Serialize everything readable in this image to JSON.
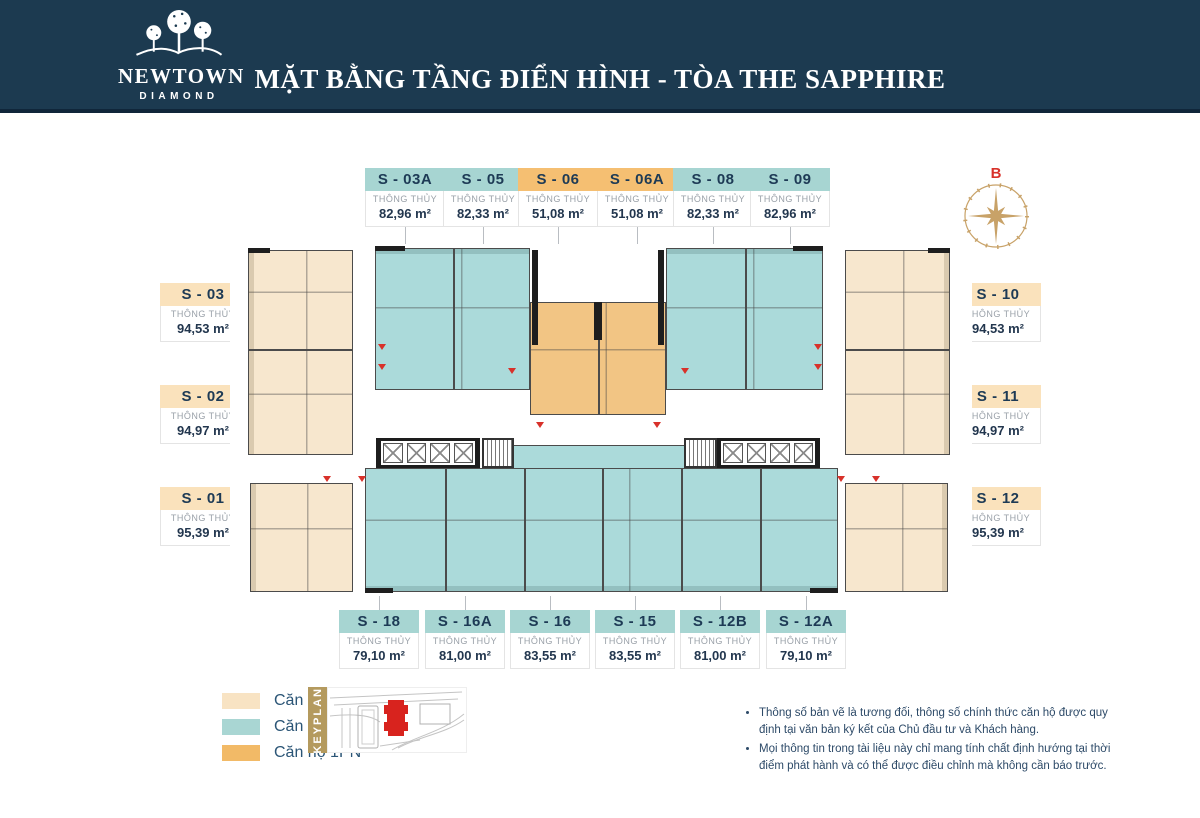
{
  "header": {
    "logo_name": "NEWTOWN",
    "logo_sub": "DIAMOND",
    "title": "MẶT BẰNG TẦNG ĐIỂN HÌNH - TÒA THE SAPPHIRE"
  },
  "compass": {
    "label": "B"
  },
  "labels": {
    "subtitle": "THÔNG THỦY"
  },
  "units": {
    "top": [
      {
        "id": "S - 03A",
        "area": "82,96 m²",
        "type": "2PN"
      },
      {
        "id": "S - 05",
        "area": "82,33 m²",
        "type": "2PN"
      },
      {
        "id": "S - 06",
        "area": "51,08 m²",
        "type": "1PN"
      },
      {
        "id": "S - 06A",
        "area": "51,08 m²",
        "type": "1PN"
      },
      {
        "id": "S - 08",
        "area": "82,33 m²",
        "type": "2PN"
      },
      {
        "id": "S - 09",
        "area": "82,96 m²",
        "type": "2PN"
      }
    ],
    "left": [
      {
        "id": "S - 03",
        "area": "94,53 m²",
        "type": "3PN"
      },
      {
        "id": "S - 02",
        "area": "94,97 m²",
        "type": "3PN"
      },
      {
        "id": "S - 01",
        "area": "95,39 m²",
        "type": "3PN"
      }
    ],
    "right": [
      {
        "id": "S - 10",
        "area": "94,53 m²",
        "type": "3PN"
      },
      {
        "id": "S - 11",
        "area": "94,97 m²",
        "type": "3PN"
      },
      {
        "id": "S - 12",
        "area": "95,39 m²",
        "type": "3PN"
      }
    ],
    "bottom": [
      {
        "id": "S - 18",
        "area": "79,10 m²",
        "type": "2PN"
      },
      {
        "id": "S - 16A",
        "area": "81,00 m²",
        "type": "2PN"
      },
      {
        "id": "S - 16",
        "area": "83,55 m²",
        "type": "2PN"
      },
      {
        "id": "S - 15",
        "area": "83,55 m²",
        "type": "2PN"
      },
      {
        "id": "S - 12B",
        "area": "81,00 m²",
        "type": "2PN"
      },
      {
        "id": "S - 12A",
        "area": "79,10 m²",
        "type": "2PN"
      }
    ]
  },
  "legend": {
    "items": [
      {
        "label": "Căn hộ 3PN",
        "color": "#f8e3c3"
      },
      {
        "label": "Căn hộ 2PN",
        "color": "#a9d6d3"
      },
      {
        "label": "Căn hộ 1PN",
        "color": "#f2ba67"
      }
    ],
    "keyplan_label": "KEYPLAN"
  },
  "notes": [
    "Thông số bản vẽ là tương đối, thông số chính thức căn hộ được quy định tại văn bản ký kết của Chủ đầu tư và Khách hàng.",
    "Mọi thông tin trong tài liệu này chỉ mang tính chất định hướng tại thời điểm phát hành và có thể được điều chỉnh mà không cần báo trước."
  ],
  "colors": {
    "header_navy": "#1c3a50",
    "accent_gold": "#b49a5e",
    "compass_gold": "#c8a268",
    "marker_red": "#d8312a",
    "plan_3pn": "#f7e7ce",
    "plan_2pn": "#abdada",
    "plan_1pn": "#f2c584"
  }
}
